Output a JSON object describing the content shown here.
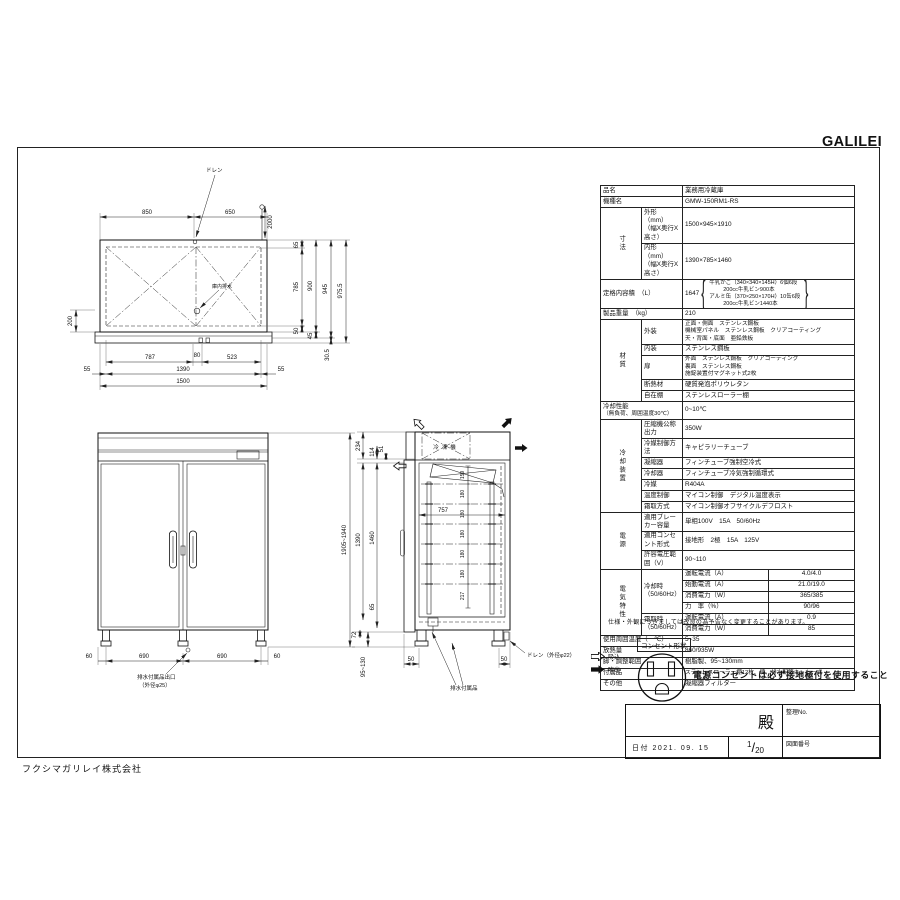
{
  "brand": {
    "logo": "GALILEI",
    "company": "フクシマガリレイ株式会社"
  },
  "spec": {
    "item_label": "品名",
    "item": "業務用冷蔵庫",
    "model_label": "機種名",
    "model": "GMW-150RM1-RS",
    "dim_group": "寸法",
    "outer_label": "外形　（mm）",
    "whd": "（幅X奥行X高さ）",
    "outer": "1500×945×1910",
    "inner_label": "内形　（mm）",
    "inner": "1390×785×1460",
    "capacity_label": "定格内容積　（L）",
    "capacity": "1647",
    "capacity_notes": [
      "牛乳かご（340×340×145H）6個6段",
      "200cc牛乳ビン900本",
      "アルミ缶（370×250×170H）10缶6段",
      "200cc牛乳ビン1440本"
    ],
    "weight_label": "製品重量　（kg）",
    "weight": "210",
    "material_group": "材質",
    "exterior_label": "外装",
    "exterior_lines": [
      "正面・側面　ステンレス鋼板",
      "機械室パネル　ステンレス鋼板　クリアコーティング",
      "天・背面・底面　亜鉛鉄板"
    ],
    "interior_label": "内装",
    "interior": "ステンレス鋼板",
    "door_label": "扉",
    "door_lines": [
      "外面　ステンレス鋼板　クリアコーティング",
      "裏面　ステンレス鋼板",
      "施錠装置付マグネット式2枚"
    ],
    "insulation_label": "断熱材",
    "insulation": "硬質発泡ポリウレタン",
    "shelf_label": "自在棚",
    "shelf": "ステンレスローラー棚",
    "cooling_perf_label": "冷却性能",
    "cooling_perf_sub": "（無負荷、周囲温度30℃）",
    "cooling_perf": "0~10℃",
    "refrig_group": "冷却装置",
    "compressor_label": "圧縮機公称出力",
    "compressor": "350W",
    "refrigerant_ctrl_label": "冷媒制御方法",
    "refrigerant_ctrl": "キャピラリーチューブ",
    "condenser_label": "凝縮器",
    "condenser": "フィンチューブ強制空冷式",
    "evaporator_label": "冷却器",
    "evaporator": "フィンチューブ冷気強制循環式",
    "refrigerant_label": "冷媒",
    "refrigerant": "R404A",
    "temp_ctrl_label": "温度制御",
    "temp_ctrl": "マイコン制御　デジタル温度表示",
    "defrost_label": "霜取方式",
    "defrost": "マイコン制御オフサイクルデフロスト",
    "power_group": "電源",
    "breaker_label": "適用ブレーカー容量",
    "breaker": "単相100V　15A　50/60Hz",
    "outlet_label": "適用コンセント形式",
    "outlet": "接地形　2極　15A　125V",
    "voltage_label": "許容電圧範囲（V）",
    "voltage": "90~110",
    "elec_group": "電気特性",
    "cooling_mode_label": "冷却時",
    "hz": "（50/60Hz）",
    "defrost_mode_label": "霜取時",
    "run_current_label": "運転電流（A）",
    "run_current": "4.0/4.0",
    "start_current_label": "始動電流（A）",
    "start_current": "21.0/19.0",
    "power_label": "消費電力（W）",
    "power": "365/385",
    "pf_label": "力　率（%）",
    "pf": "90/96",
    "defrost_current": "0.9",
    "defrost_power": "85",
    "ambient_label": "使用周囲温度（　℃）",
    "ambient": "5~35",
    "heat_label": "放熱量",
    "heat": "860/935W",
    "legs_label": "脚・調整範囲",
    "legs": "樹脂製、95~130mm",
    "accessories_label": "付属品",
    "accessories": "ステンレスローラー棚12枚、鍵、排水配管キット一式",
    "other_label": "その他",
    "other": "凝縮器フィルター",
    "note": "仕様・外観につきましては改良の為予告なく変更することがあります。"
  },
  "legend": {
    "intake": "吸込",
    "blowout": "吹出",
    "outlet_shape": "コンセント形状",
    "warning": "電源コンセントは必ず接地極付を使用すること"
  },
  "title_block": {
    "dono": "殿",
    "seiri_no": "整理No.",
    "date": "日付 2021. 09. 15",
    "scale_num": "1",
    "scale_slash": "/",
    "scale_den": "20",
    "zuban": "図面番号"
  },
  "top_view": {
    "drain": "ドレン",
    "inner_drain": "庫内排水",
    "d850": "850",
    "d650": "650",
    "d2000": "2000",
    "d65": "65",
    "d785": "785",
    "d50": "50",
    "d900": "900",
    "d45": "45",
    "d945": "945",
    "d975_5": "975.5",
    "d30_5": "30.5",
    "d200": "200",
    "d787": "787",
    "d80": "80",
    "d523": "523",
    "d55": "55",
    "d1390": "1390",
    "d1500": "1500"
  },
  "front_view": {
    "height_range": "1905~1940",
    "d60": "60",
    "d690": "690",
    "drain_label1": "排水付属品出口",
    "drain_label2": "（外径φ25）"
  },
  "side_view": {
    "unit_label": "冷凍機",
    "d234": "234",
    "d114": "114",
    "d51": "51",
    "d1390": "1390",
    "d1460": "1460",
    "d65": "65",
    "d72": "72",
    "d95_130": "95~130",
    "d757": "757",
    "d159": "159",
    "d180": "180",
    "d217": "217",
    "d50": "50",
    "drain": "ドレン（外径φ22）",
    "drain_acc": "排水付属品"
  }
}
